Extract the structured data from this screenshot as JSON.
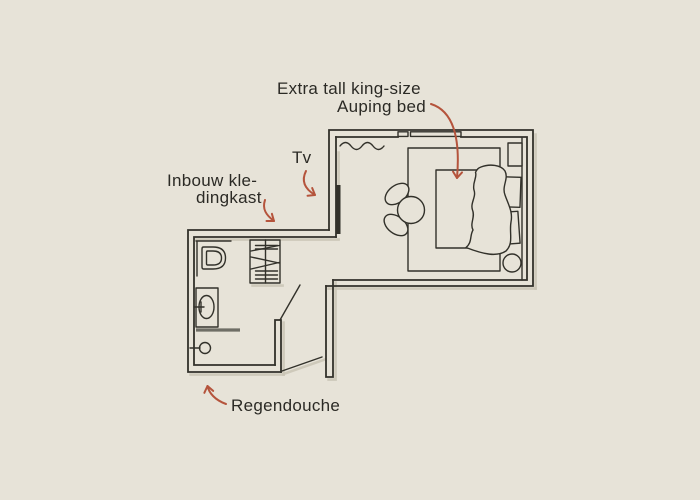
{
  "canvas": {
    "width": 700,
    "height": 500
  },
  "colors": {
    "background": "#e7e3d8",
    "line": "#32312a",
    "text": "#2b2a25",
    "arrow": "#b5543c",
    "glass": "#6f6e66",
    "shadow": "#c9c4b5"
  },
  "annotations": {
    "bed": {
      "line1": "Extra tall king-size",
      "line2": "Auping bed",
      "target": "bed"
    },
    "tv": {
      "text": "Tv",
      "target": "tv"
    },
    "wardrobe": {
      "line1": "Inbouw kle-",
      "line2": "dingkast",
      "target": "built-in-wardrobe"
    },
    "shower": {
      "text": "Regendouche",
      "target": "rain-shower"
    }
  },
  "floorplan": {
    "rooms": [
      "bedroom",
      "bathroom",
      "entrance-hall"
    ],
    "symbols": [
      "bed",
      "pillows",
      "duvet",
      "headboard",
      "nightstand",
      "side-table",
      "armchair",
      "rug",
      "tv",
      "window",
      "curtain",
      "wardrobe-hanger-rail",
      "toilet",
      "washbasin",
      "tap",
      "shower-screen",
      "shower-head",
      "bathroom-door-leaf",
      "entrance-door-leaf"
    ]
  }
}
